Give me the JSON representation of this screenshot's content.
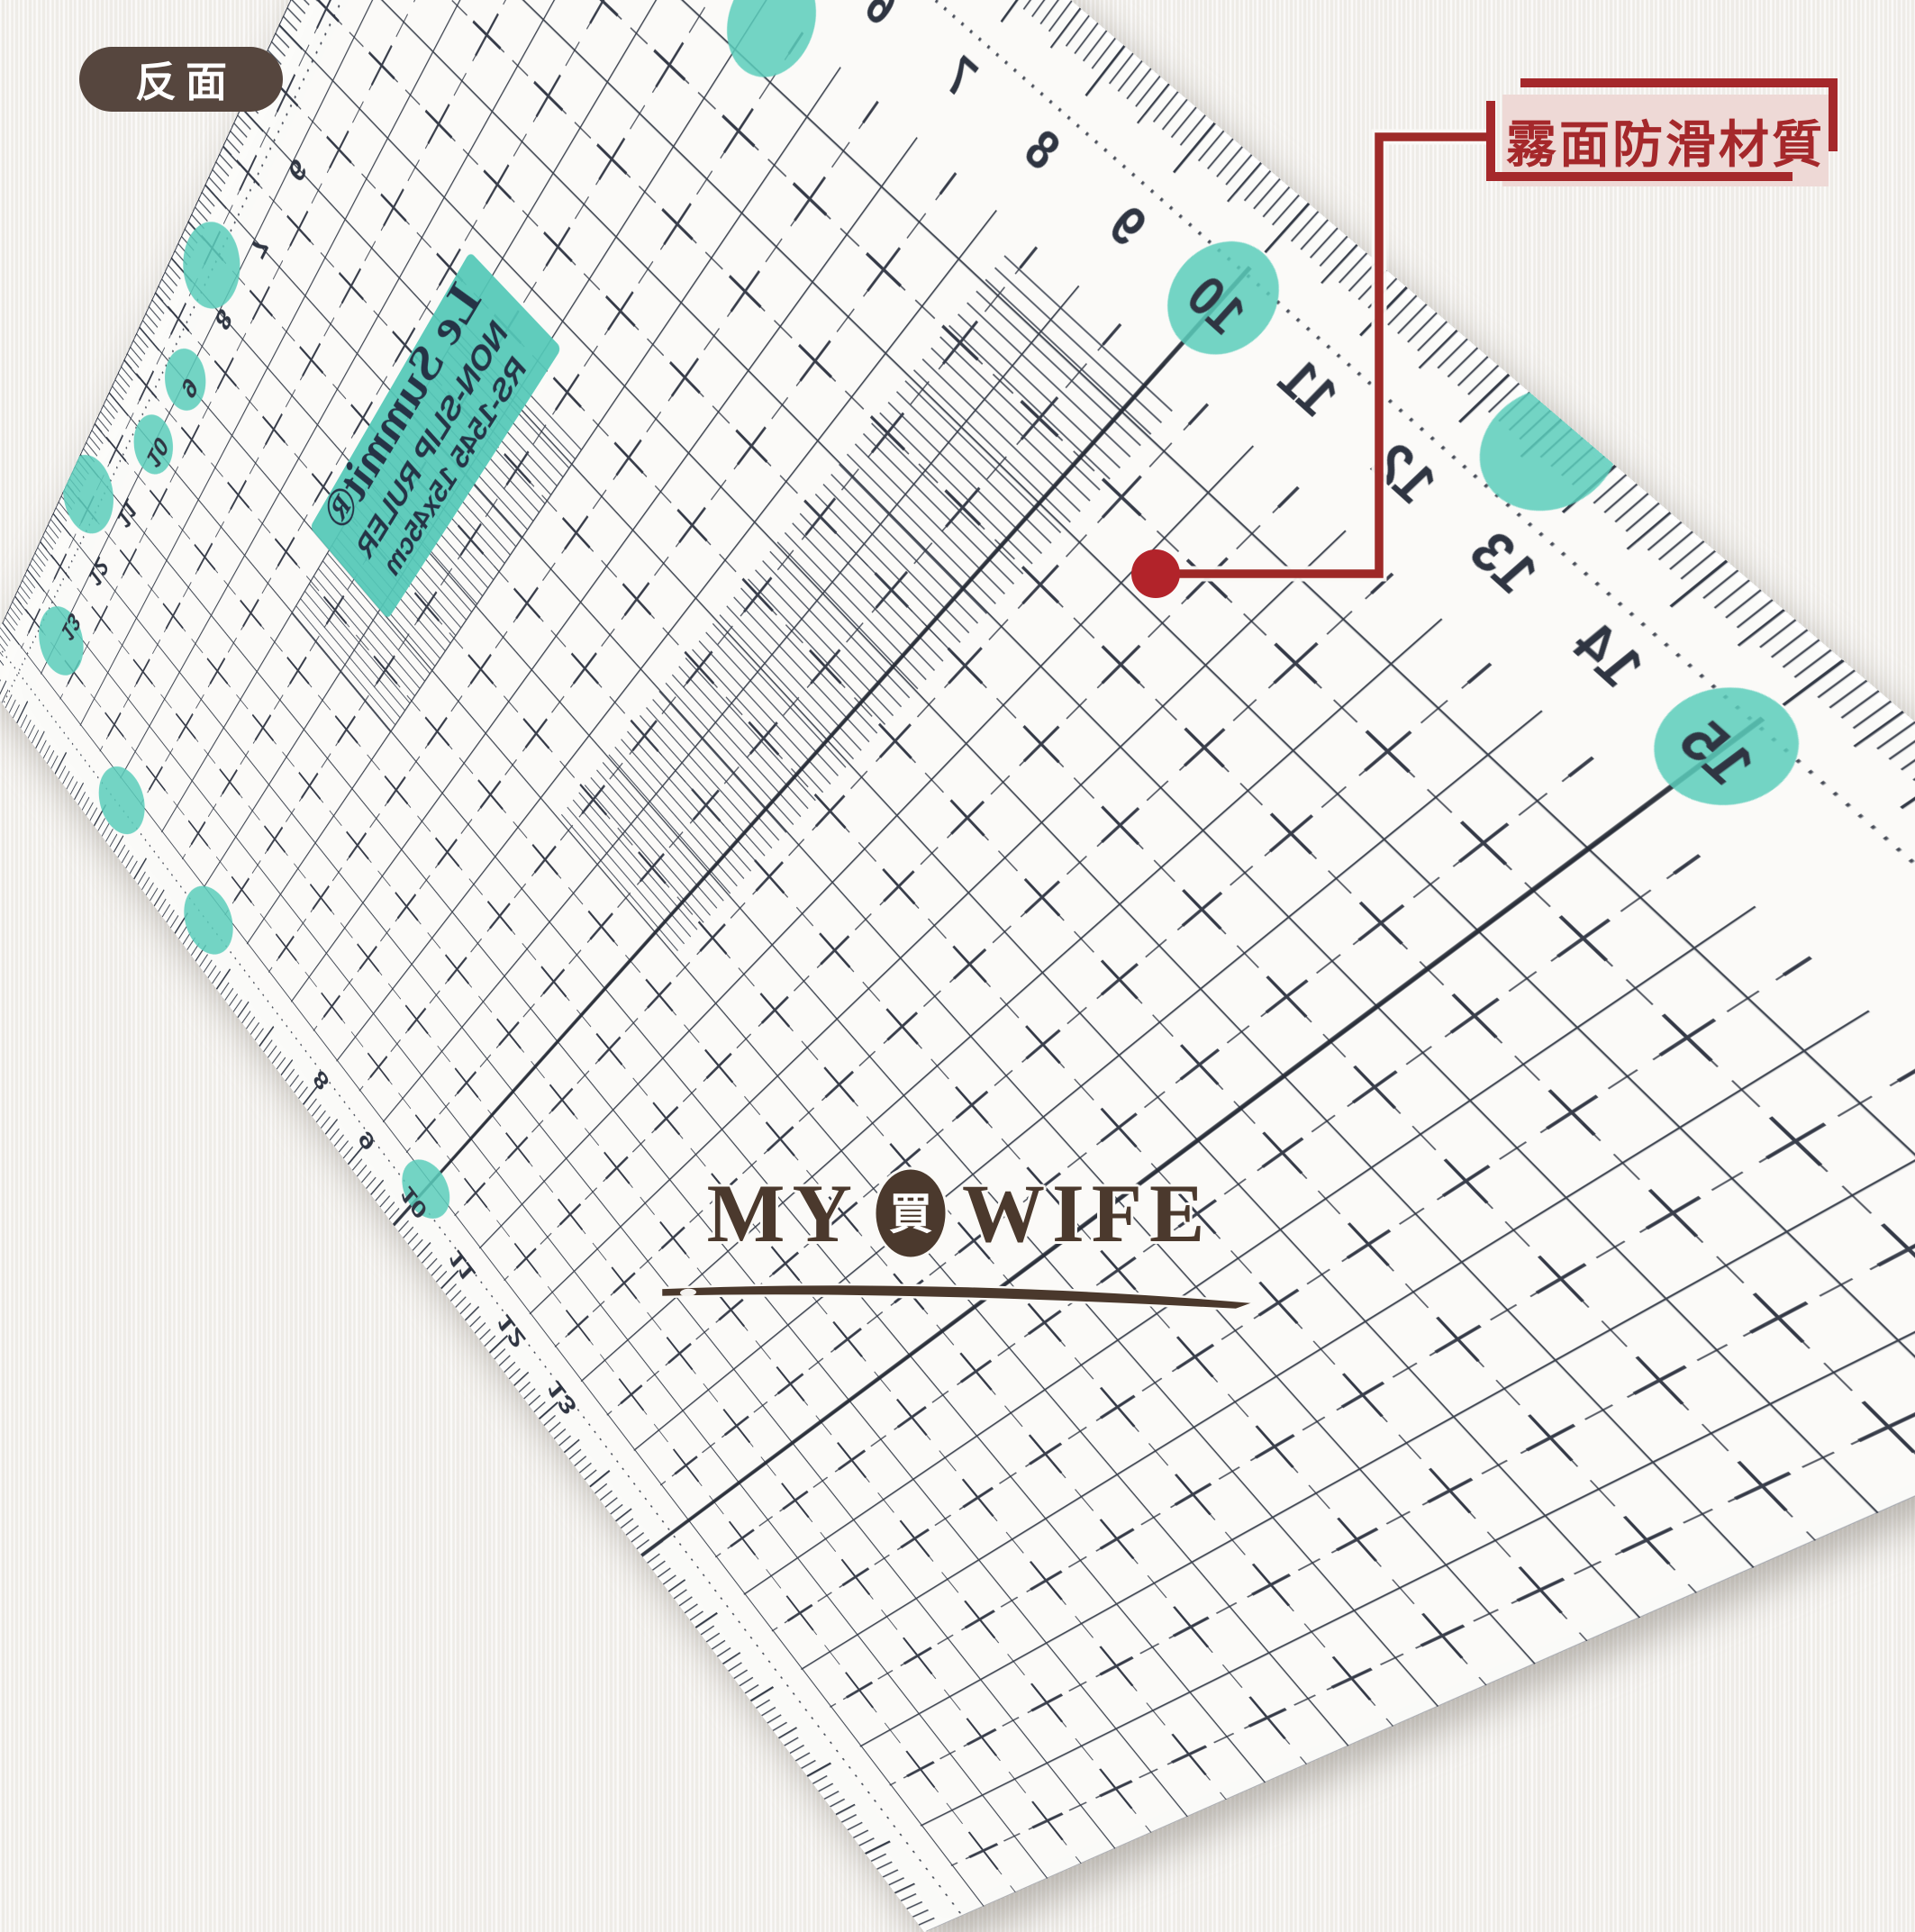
{
  "badge": {
    "label": "反面",
    "bg_color": "#56463e"
  },
  "annotation": {
    "label": "霧面防滑材質",
    "accent_color": "#a5282b",
    "box_bg": "#eed9d6",
    "dot_color": "#b2232a"
  },
  "ruler": {
    "ink": "#2f3542",
    "teal": "#5accbb",
    "brand_label": {
      "line1": "Le Summit®",
      "line2": "NON-SLIP RULER",
      "line3": "RS-1545  15x45cm"
    },
    "scales": {
      "top": {
        "values": [
          6,
          7,
          8,
          9,
          10,
          11,
          12,
          13,
          14,
          15
        ],
        "circled": [
          10,
          15
        ]
      },
      "left": {
        "values": [
          6,
          7,
          8,
          9,
          10,
          11,
          12,
          13
        ],
        "circled": [
          9,
          10
        ]
      },
      "bottom": {
        "values": [
          8,
          9,
          10,
          11,
          12,
          13
        ],
        "circled": [
          10
        ]
      }
    },
    "grip_dots": [
      [
        775,
        245,
        68
      ],
      [
        90,
        1150,
        72
      ],
      [
        60,
        1700,
        75
      ],
      [
        160,
        2000,
        70
      ],
      [
        480,
        2140,
        70
      ],
      [
        800,
        2150,
        70
      ],
      [
        1890,
        30,
        66
      ]
    ]
  },
  "logo": {
    "word_left": "MY",
    "emblem": "買",
    "word_right": "WIFE",
    "color": "#4b392d"
  }
}
